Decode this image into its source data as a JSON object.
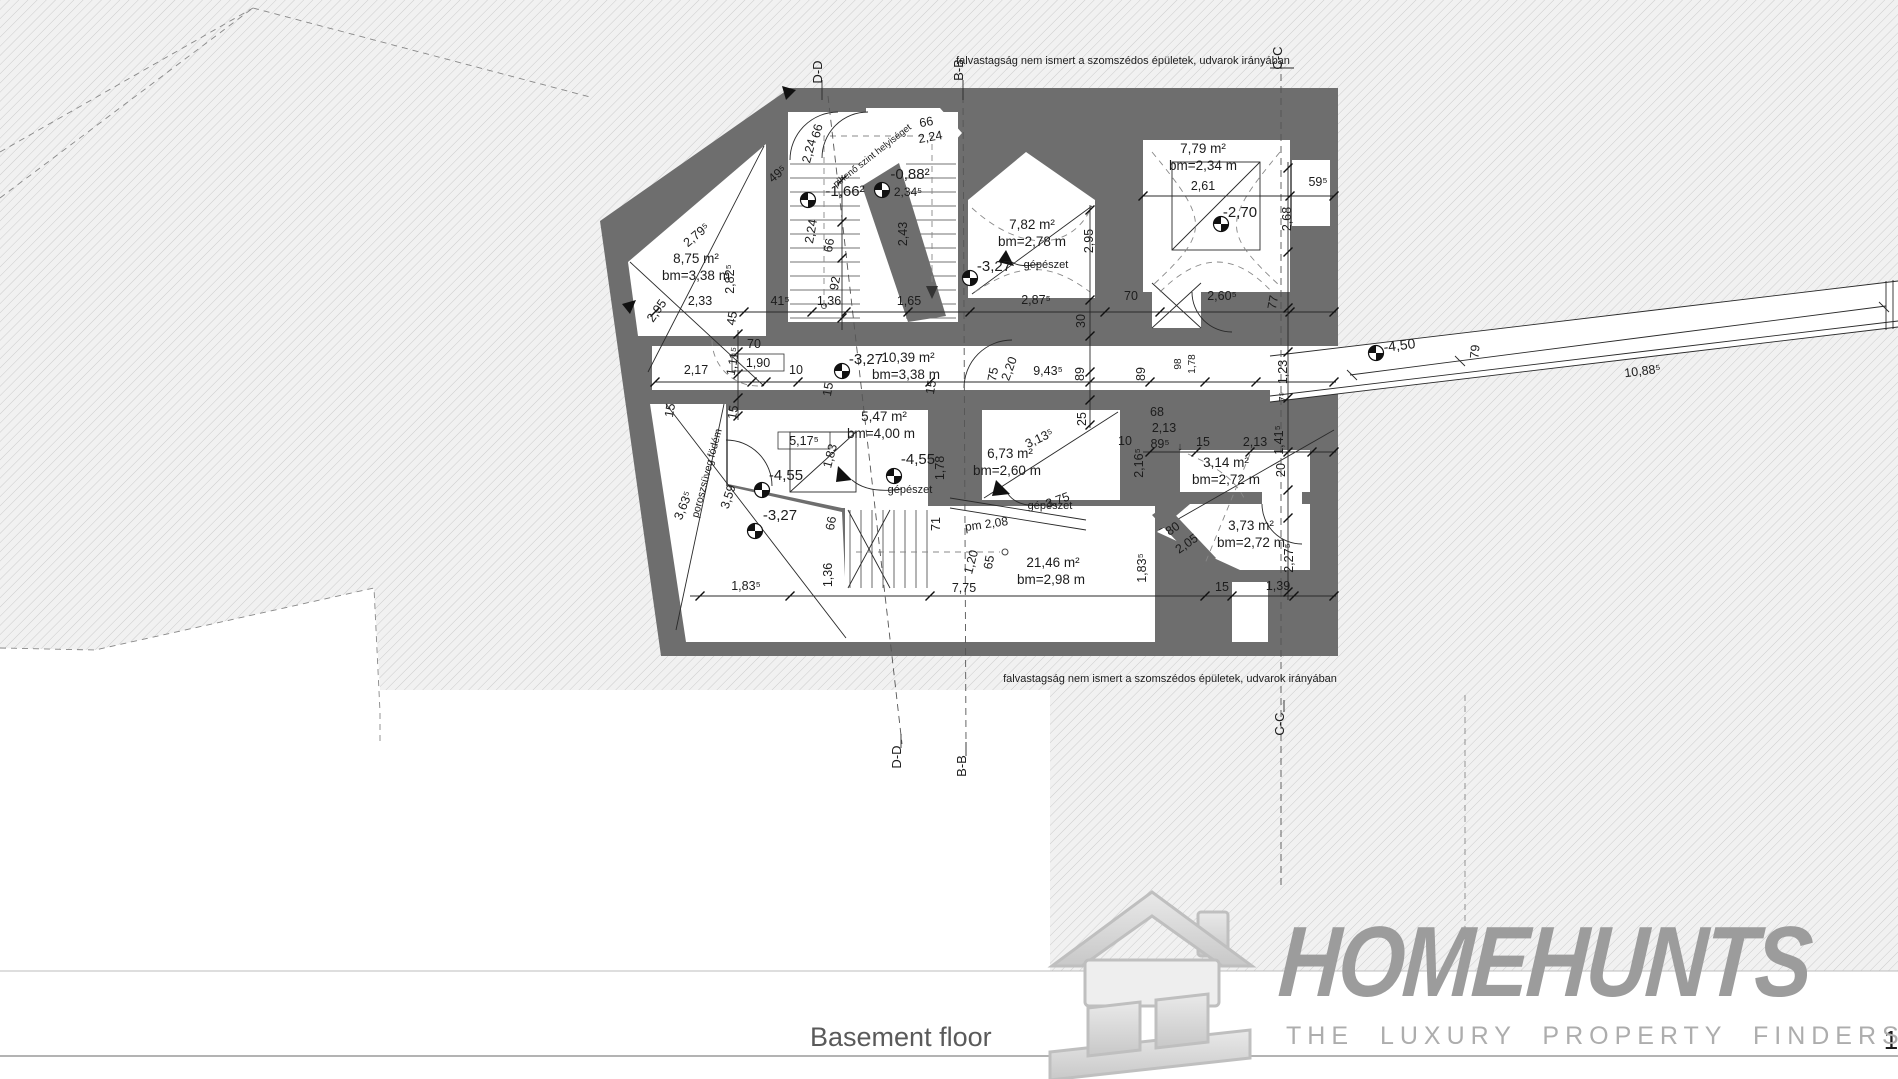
{
  "plan": {
    "colors": {
      "wall": "#6e6e6e",
      "hatch_bg": "#f0f0f0",
      "hatch_line": "#cccccc",
      "line": "#2a2a2a",
      "logo_gray": "#9c9c9c"
    },
    "notes": {
      "top": "falvastagság nem ismert a szomszédos épületek, udvarok irányában",
      "bottom": "falvastagság nem ismert a szomszédos épületek, udvarok irányában"
    },
    "labels": [
      {
        "t": "falvastagság nem ismert a szomszédos épületek, udvarok irányában",
        "x": 1123,
        "y": 64,
        "s": 11,
        "n": "boundary-note"
      },
      {
        "t": "falvastagság nem ismert a szomszédos épületek, udvarok irányában",
        "x": 1170,
        "y": 682,
        "s": 11,
        "n": "boundary-note"
      },
      {
        "t": "D-D",
        "x": 822,
        "y": 72,
        "r": -90,
        "s": 13,
        "n": "section-label"
      },
      {
        "t": "B-B",
        "x": 963,
        "y": 70,
        "r": -90,
        "s": 13,
        "n": "section-label"
      },
      {
        "t": "C-C",
        "x": 1282,
        "y": 58,
        "r": -90,
        "s": 13,
        "n": "section-label"
      },
      {
        "t": "D-D",
        "x": 901,
        "y": 757,
        "r": -90,
        "s": 13,
        "n": "section-label"
      },
      {
        "t": "B-B",
        "x": 966,
        "y": 766,
        "r": -90,
        "s": 13,
        "n": "section-label"
      },
      {
        "t": "C-C",
        "x": 1284,
        "y": 724,
        "r": -90,
        "s": 13,
        "n": "section-label"
      },
      {
        "t": "8,75 m²",
        "x": 696,
        "y": 263,
        "s": 13.5,
        "n": "room-area-label"
      },
      {
        "t": "bm=3,38 m",
        "x": 696,
        "y": 280,
        "s": 13.5,
        "n": "room-height-label"
      },
      {
        "t": "7,82 m²",
        "x": 1032,
        "y": 229,
        "s": 13.5,
        "n": "room-area-label"
      },
      {
        "t": "bm=2,78 m",
        "x": 1032,
        "y": 246,
        "s": 13.5,
        "n": "room-height-label"
      },
      {
        "t": "7,79 m²",
        "x": 1203,
        "y": 153,
        "s": 13.5,
        "n": "room-area-label"
      },
      {
        "t": "bm=2,34 m",
        "x": 1203,
        "y": 170,
        "s": 13.5,
        "n": "room-height-label"
      },
      {
        "t": "10,39 m²",
        "x": 908,
        "y": 362,
        "s": 13.5,
        "n": "room-area-label"
      },
      {
        "t": "bm=3,38 m",
        "x": 906,
        "y": 379,
        "s": 13.5,
        "n": "room-height-label"
      },
      {
        "t": "5,47 m²",
        "x": 884,
        "y": 421,
        "s": 13.5,
        "n": "room-area-label"
      },
      {
        "t": "bm=4,00 m",
        "x": 881,
        "y": 438,
        "s": 13.5,
        "n": "room-height-label"
      },
      {
        "t": "6,73 m²",
        "x": 1010,
        "y": 458,
        "s": 13.5,
        "n": "room-area-label"
      },
      {
        "t": "bm=2,60 m",
        "x": 1007,
        "y": 475,
        "s": 13.5,
        "n": "room-height-label"
      },
      {
        "t": "3,14 m²",
        "x": 1226,
        "y": 467,
        "s": 13.5,
        "n": "room-area-label"
      },
      {
        "t": "bm=2,72 m",
        "x": 1226,
        "y": 484,
        "s": 13.5,
        "n": "room-height-label"
      },
      {
        "t": "3,73 m²",
        "x": 1251,
        "y": 530,
        "s": 13.5,
        "n": "room-area-label"
      },
      {
        "t": "bm=2,72 m",
        "x": 1251,
        "y": 547,
        "s": 13.5,
        "n": "room-height-label"
      },
      {
        "t": "21,46 m²",
        "x": 1053,
        "y": 567,
        "s": 13.5,
        "n": "room-area-label"
      },
      {
        "t": "bm=2,98 m",
        "x": 1051,
        "y": 584,
        "s": 13.5,
        "n": "room-height-label"
      },
      {
        "t": "-1,66²",
        "x": 845,
        "y": 196,
        "s": 15,
        "n": "elevation-label"
      },
      {
        "t": "-0,88²",
        "x": 910,
        "y": 179,
        "s": 15,
        "n": "elevation-label"
      },
      {
        "t": "2,34⁵",
        "x": 908,
        "y": 196,
        "s": 12,
        "n": "dim-label"
      },
      {
        "t": "-3,27",
        "x": 994,
        "y": 271,
        "s": 15,
        "n": "elevation-label"
      },
      {
        "t": "-2,70",
        "x": 1240,
        "y": 217,
        "s": 15,
        "n": "elevation-label"
      },
      {
        "t": "-3,27",
        "x": 866,
        "y": 364,
        "s": 15,
        "n": "elevation-label"
      },
      {
        "t": "-4,55",
        "x": 786,
        "y": 480,
        "s": 15,
        "n": "elevation-label"
      },
      {
        "t": "-4,55",
        "x": 918,
        "y": 464,
        "s": 15,
        "n": "elevation-label"
      },
      {
        "t": "-3,27",
        "x": 780,
        "y": 520,
        "s": 15,
        "n": "elevation-label"
      },
      {
        "t": "-4,50",
        "x": 1400,
        "y": 350,
        "r": -7,
        "s": 14,
        "n": "elevation-label"
      },
      {
        "t": "gépészet",
        "x": 1046,
        "y": 268,
        "s": 11,
        "n": "annotation-label"
      },
      {
        "t": "gépészet",
        "x": 910,
        "y": 493,
        "s": 11,
        "n": "annotation-label"
      },
      {
        "t": "gépészet",
        "x": 1050,
        "y": 509,
        "s": 11,
        "n": "annotation-label"
      },
      {
        "t": "pihenő szint helyiséget",
        "x": 874,
        "y": 158,
        "r": -38,
        "s": 9.5,
        "n": "annotation-label"
      },
      {
        "t": "poroszsüveg födém",
        "x": 710,
        "y": 474,
        "r": -75,
        "s": 10.5,
        "n": "annotation-label"
      },
      {
        "t": "pm 2,08",
        "x": 987,
        "y": 528,
        "r": -8,
        "s": 12,
        "n": "annotation-label"
      },
      {
        "t": "2,33",
        "x": 700,
        "y": 305,
        "n": "dim-label"
      },
      {
        "t": "41⁵",
        "x": 780,
        "y": 305,
        "n": "dim-label"
      },
      {
        "t": "1,36",
        "x": 829,
        "y": 305,
        "n": "dim-label"
      },
      {
        "t": "1,65",
        "x": 909,
        "y": 305,
        "n": "dim-label"
      },
      {
        "t": "2,87⁵",
        "x": 1036,
        "y": 304,
        "n": "dim-label"
      },
      {
        "t": "70",
        "x": 1131,
        "y": 300,
        "n": "dim-label"
      },
      {
        "t": "2,60⁵",
        "x": 1222,
        "y": 300,
        "n": "dim-label"
      },
      {
        "t": "2,61",
        "x": 1203,
        "y": 190,
        "n": "dim-label"
      },
      {
        "t": "59⁵",
        "x": 1318,
        "y": 186,
        "n": "dim-label"
      },
      {
        "t": "2,17",
        "x": 696,
        "y": 374,
        "n": "dim-label"
      },
      {
        "t": "70",
        "x": 754,
        "y": 348,
        "n": "dim-label"
      },
      {
        "t": "1,90",
        "x": 758,
        "y": 367,
        "b": 1,
        "n": "dim-label"
      },
      {
        "t": "10",
        "x": 796,
        "y": 374,
        "n": "dim-label"
      },
      {
        "t": "9,43⁵",
        "x": 1048,
        "y": 375,
        "n": "dim-label"
      },
      {
        "t": "7,75",
        "x": 964,
        "y": 592,
        "n": "dim-label"
      },
      {
        "t": "1,83⁵",
        "x": 746,
        "y": 590,
        "n": "dim-label"
      },
      {
        "t": "15",
        "x": 1222,
        "y": 591,
        "n": "dim-label"
      },
      {
        "t": "1,39",
        "x": 1278,
        "y": 590,
        "n": "dim-label"
      },
      {
        "t": "68",
        "x": 1157,
        "y": 416,
        "n": "dim-label"
      },
      {
        "t": "2,13",
        "x": 1164,
        "y": 432,
        "n": "dim-label"
      },
      {
        "t": "89⁵",
        "x": 1160,
        "y": 448,
        "n": "dim-label"
      },
      {
        "t": "↓",
        "x": 1180,
        "y": 450,
        "s": 11,
        "n": "dim-label"
      },
      {
        "t": "15",
        "x": 1203,
        "y": 446,
        "n": "dim-label"
      },
      {
        "t": "2,13",
        "x": 1255,
        "y": 446,
        "n": "dim-label"
      },
      {
        "t": "10",
        "x": 1125,
        "y": 445,
        "n": "dim-label"
      },
      {
        "t": "3,13⁵",
        "x": 1041,
        "y": 442,
        "r": -25,
        "n": "dim-label"
      },
      {
        "t": "3,75",
        "x": 1059,
        "y": 504,
        "r": -20,
        "n": "dim-label"
      },
      {
        "t": "5,17⁵",
        "x": 804,
        "y": 445,
        "b": 1,
        "n": "dim-label"
      },
      {
        "t": "80",
        "x": 1175,
        "y": 532,
        "r": -35,
        "n": "dim-label"
      },
      {
        "t": "2,05",
        "x": 1189,
        "y": 547,
        "r": -35,
        "n": "dim-label"
      },
      {
        "t": "2,24",
        "x": 931,
        "y": 141,
        "r": -10,
        "n": "dim-label"
      },
      {
        "t": "66",
        "x": 927,
        "y": 126,
        "r": -10,
        "n": "dim-label"
      },
      {
        "t": "49⁵",
        "x": 780,
        "y": 177,
        "r": -40,
        "n": "dim-label"
      },
      {
        "t": "2,79⁵",
        "x": 699,
        "y": 238,
        "r": -40,
        "n": "dim-label"
      },
      {
        "t": "2,95",
        "x": 660,
        "y": 313,
        "r": -55,
        "n": "dim-label"
      },
      {
        "t": "3,63⁵",
        "x": 687,
        "y": 507,
        "r": -68,
        "n": "dim-label"
      },
      {
        "t": "10,88⁵",
        "x": 1643,
        "y": 375,
        "r": -7,
        "n": "dim-label"
      },
      {
        "t": "2,95",
        "x": 1093,
        "y": 241,
        "r": -90,
        "n": "dim-label"
      },
      {
        "t": "2,82⁵",
        "x": 734,
        "y": 279,
        "r": -90,
        "n": "dim-label"
      },
      {
        "t": "2,24",
        "x": 815,
        "y": 232,
        "r": -80,
        "n": "dim-label"
      },
      {
        "t": "66",
        "x": 833,
        "y": 246,
        "r": -80,
        "n": "dim-label"
      },
      {
        "t": "92",
        "x": 839,
        "y": 284,
        "r": -80,
        "n": "dim-label"
      },
      {
        "t": "2,43",
        "x": 907,
        "y": 234,
        "r": -90,
        "n": "dim-label"
      },
      {
        "t": "2,24",
        "x": 813,
        "y": 152,
        "r": -75,
        "n": "dim-label"
      },
      {
        "t": "66",
        "x": 821,
        "y": 132,
        "r": -75,
        "n": "dim-label"
      },
      {
        "t": "2,68",
        "x": 1291,
        "y": 219,
        "r": -90,
        "n": "dim-label"
      },
      {
        "t": "45",
        "x": 736,
        "y": 319,
        "r": -80,
        "n": "dim-label"
      },
      {
        "t": "1,11⁵",
        "x": 737,
        "y": 362,
        "r": -80,
        "n": "dim-label"
      },
      {
        "t": "15",
        "x": 674,
        "y": 411,
        "r": -80,
        "n": "dim-label"
      },
      {
        "t": "15",
        "x": 737,
        "y": 413,
        "r": -80,
        "n": "dim-label"
      },
      {
        "t": "15",
        "x": 832,
        "y": 390,
        "r": -80,
        "n": "dim-label"
      },
      {
        "t": "15",
        "x": 935,
        "y": 388,
        "r": -80,
        "n": "dim-label"
      },
      {
        "t": "30",
        "x": 1085,
        "y": 321,
        "r": -90,
        "n": "dim-label"
      },
      {
        "t": "77",
        "x": 1277,
        "y": 303,
        "r": -80,
        "n": "dim-label"
      },
      {
        "t": "75",
        "x": 997,
        "y": 375,
        "r": -80,
        "n": "dim-label"
      },
      {
        "t": "2,20",
        "x": 1013,
        "y": 370,
        "r": -70,
        "n": "dim-label"
      },
      {
        "t": "89",
        "x": 1084,
        "y": 374,
        "r": -90,
        "n": "dim-label"
      },
      {
        "t": "89",
        "x": 1145,
        "y": 374,
        "r": -90,
        "n": "dim-label"
      },
      {
        "t": "98",
        "x": 1181,
        "y": 364,
        "r": -90,
        "s": 10,
        "n": "dim-label"
      },
      {
        "t": "1,78",
        "x": 1195,
        "y": 364,
        "r": -90,
        "s": 10,
        "n": "dim-label"
      },
      {
        "t": "1,23",
        "x": 1287,
        "y": 372,
        "r": -90,
        "n": "dim-label"
      },
      {
        "t": "7⁵",
        "x": 1286,
        "y": 397,
        "r": -90,
        "s": 10,
        "n": "dim-label"
      },
      {
        "t": "25",
        "x": 1086,
        "y": 419,
        "r": -90,
        "n": "dim-label"
      },
      {
        "t": "2,16⁵",
        "x": 1143,
        "y": 463,
        "r": -90,
        "n": "dim-label"
      },
      {
        "t": "1,41⁵",
        "x": 1283,
        "y": 440,
        "r": -90,
        "n": "dim-label"
      },
      {
        "t": "20",
        "x": 1285,
        "y": 470,
        "r": -90,
        "n": "dim-label"
      },
      {
        "t": "1,83",
        "x": 834,
        "y": 457,
        "r": -75,
        "n": "dim-label"
      },
      {
        "t": "1,78",
        "x": 944,
        "y": 468,
        "r": -90,
        "n": "dim-label"
      },
      {
        "t": "66",
        "x": 835,
        "y": 524,
        "r": -80,
        "n": "dim-label"
      },
      {
        "t": "71",
        "x": 940,
        "y": 524,
        "r": -90,
        "n": "dim-label"
      },
      {
        "t": "1,36",
        "x": 832,
        "y": 575,
        "r": -90,
        "n": "dim-label"
      },
      {
        "t": "1,20",
        "x": 975,
        "y": 563,
        "r": -75,
        "n": "dim-label"
      },
      {
        "t": "65",
        "x": 993,
        "y": 563,
        "r": -80,
        "n": "dim-label"
      },
      {
        "t": "1,83⁵",
        "x": 1146,
        "y": 568,
        "r": -90,
        "n": "dim-label"
      },
      {
        "t": "2,27⁵",
        "x": 1293,
        "y": 558,
        "r": -90,
        "n": "dim-label"
      },
      {
        "t": "3,59",
        "x": 732,
        "y": 498,
        "r": -72,
        "n": "dim-label"
      },
      {
        "t": "79",
        "x": 1479,
        "y": 352,
        "r": -85,
        "n": "dim-label"
      },
      {
        "t": "1",
        "x": 1891,
        "y": 1049,
        "s": 26,
        "n": "edge-fragment"
      }
    ],
    "markers": [
      {
        "x": 808,
        "y": 200
      },
      {
        "x": 882,
        "y": 190
      },
      {
        "x": 970,
        "y": 278
      },
      {
        "x": 1221,
        "y": 224
      },
      {
        "x": 842,
        "y": 371
      },
      {
        "x": 762,
        "y": 490
      },
      {
        "x": 894,
        "y": 476
      },
      {
        "x": 755,
        "y": 531
      },
      {
        "x": 1376,
        "y": 353
      }
    ]
  },
  "titlebar": {
    "floor_label": "Basement floor"
  },
  "logo": {
    "name": "HOMEHUNTS",
    "tagline": "THE LUXURY PROPERTY FINDERS"
  }
}
